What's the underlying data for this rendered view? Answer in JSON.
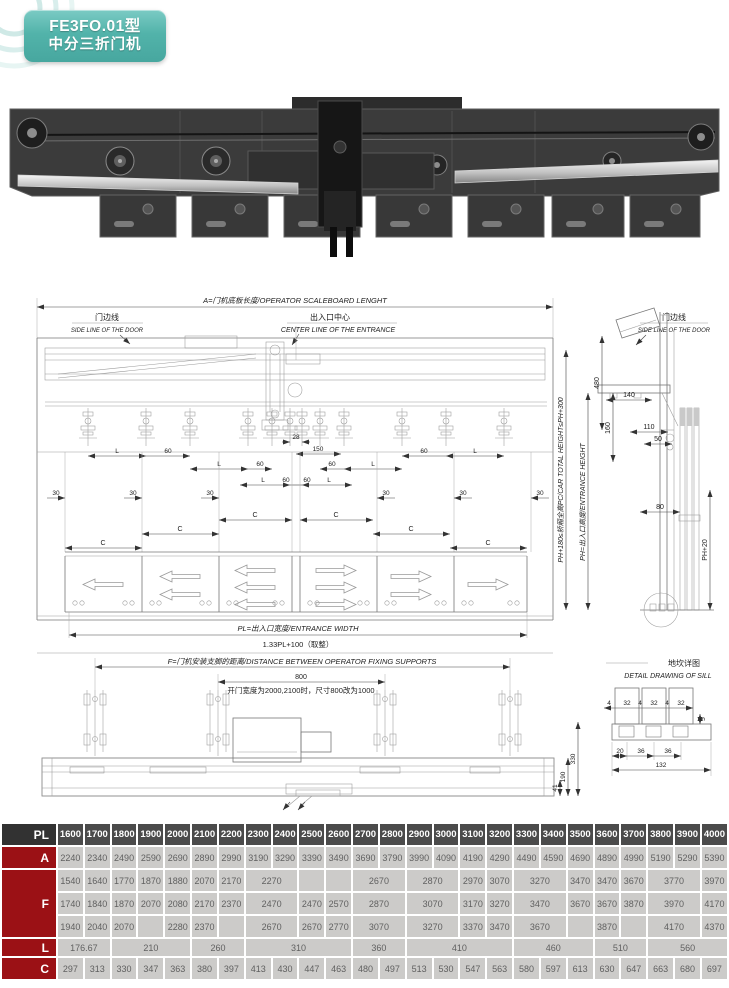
{
  "badge": {
    "model": "FE3FO.01型",
    "name": "中分三折门机"
  },
  "drawing_main": {
    "title": "A=门机底板长度/OPERATOR  SCALEBOARD  LENGHT",
    "side_line_cn": "门边线",
    "side_line_en": "SIDE LINE OF THE DOOR",
    "center_cn": "出入口中心",
    "center_en": "CENTER LINE OF THE ENTRANCE",
    "dim_L": "L",
    "dim_60": "60",
    "dim_30": "30",
    "dim_C": "C",
    "dim_28": "28",
    "dim_150": "150",
    "pl_label": "PL=出入口宽度/ENTRANCE WIDTH",
    "pl_formula": "1.33PL+100（取整）"
  },
  "drawing_section": {
    "d480": "480",
    "d140": "140",
    "d160": "160",
    "d110": "110",
    "d50": "50",
    "d80": "80",
    "ph20": "PH+20",
    "car_total_height": "PH+180≤轿厢全高PC/CAR  TOTAL  HEIGHT≤PH+300",
    "entrance_height": "PH=出入口高度/ENTRANCE  HEIGHT"
  },
  "drawing_fixing": {
    "title": "F=门机安装支脚的距离/DISTANCE  BETWEEN  OPERATOR  FIXING  SUPPORTS",
    "d800": "800",
    "note": "开门宽度为2000,2100时，尺寸800改为1000",
    "d41": "41",
    "d190": "190",
    "d330": "330"
  },
  "drawing_sill": {
    "title_cn": "地坎详图",
    "title_en": "DETAIL  DRAWING  OF  SILL",
    "d4": "4",
    "d32": "32",
    "d5": "5",
    "d20": "20",
    "d36": "36",
    "d132": "132"
  },
  "table": {
    "row_labels": {
      "pl": "PL",
      "a": "A",
      "f": "F",
      "l": "L",
      "c": "C"
    },
    "columns": [
      "1600",
      "1700",
      "1800",
      "1900",
      "2000",
      "2100",
      "2200",
      "2300",
      "2400",
      "2500",
      "2600",
      "2700",
      "2800",
      "2900",
      "3000",
      "3100",
      "3200",
      "3300",
      "3400",
      "3500",
      "3600",
      "3700",
      "3800",
      "3900",
      "4000"
    ],
    "row_a": [
      "2240",
      "2340",
      "2490",
      "2590",
      "2690",
      "2890",
      "2990",
      "3190",
      "3290",
      "3390",
      "3490",
      "3690",
      "3790",
      "3990",
      "4090",
      "4190",
      "4290",
      "4490",
      "4590",
      "4690",
      "4890",
      "4990",
      "5190",
      "5290",
      "5390"
    ],
    "row_f": [
      [
        [
          "1540",
          1
        ],
        [
          "1640",
          1
        ],
        [
          "1770",
          1
        ],
        [
          "1870",
          1
        ],
        [
          "1880",
          1
        ],
        [
          "2070",
          1
        ],
        [
          "2170",
          1
        ],
        [
          "2270",
          2
        ],
        [
          "",
          1
        ],
        [
          "",
          1
        ],
        [
          "2670",
          2
        ],
        [
          "2870",
          2
        ],
        [
          "2970",
          1
        ],
        [
          "3070",
          1
        ],
        [
          "3270",
          2
        ],
        [
          "3470",
          1
        ],
        [
          "3470",
          1
        ],
        [
          "3670",
          1
        ],
        [
          "3770",
          2
        ],
        [
          "3970",
          1
        ]
      ],
      [
        [
          "1740",
          1
        ],
        [
          "1840",
          1
        ],
        [
          "1870",
          1
        ],
        [
          "2070",
          1
        ],
        [
          "2080",
          1
        ],
        [
          "2170",
          1
        ],
        [
          "2370",
          1
        ],
        [
          "2470",
          2
        ],
        [
          "2470",
          1
        ],
        [
          "2570",
          1
        ],
        [
          "2870",
          2
        ],
        [
          "3070",
          2
        ],
        [
          "3170",
          1
        ],
        [
          "3270",
          1
        ],
        [
          "3470",
          2
        ],
        [
          "3670",
          1
        ],
        [
          "3670",
          1
        ],
        [
          "3870",
          1
        ],
        [
          "3970",
          2
        ],
        [
          "4170",
          1
        ]
      ],
      [
        [
          "1940",
          1
        ],
        [
          "2040",
          1
        ],
        [
          "2070",
          1
        ],
        [
          "",
          1
        ],
        [
          "2280",
          1
        ],
        [
          "2370",
          1
        ],
        [
          "",
          1
        ],
        [
          "2670",
          2
        ],
        [
          "2670",
          1
        ],
        [
          "2770",
          1
        ],
        [
          "3070",
          2
        ],
        [
          "3270",
          2
        ],
        [
          "3370",
          1
        ],
        [
          "3470",
          1
        ],
        [
          "3670",
          2
        ],
        [
          "",
          1
        ],
        [
          "3870",
          1
        ],
        [
          "",
          1
        ],
        [
          "4170",
          2
        ],
        [
          "4370",
          1
        ]
      ]
    ],
    "row_l": [
      [
        "176.67",
        2
      ],
      [
        "210",
        3
      ],
      [
        "260",
        2
      ],
      [
        "310",
        4
      ],
      [
        "360",
        2
      ],
      [
        "410",
        4
      ],
      [
        "460",
        3
      ],
      [
        "510",
        2
      ],
      [
        "560",
        3
      ]
    ],
    "row_c": [
      "297",
      "313",
      "330",
      "347",
      "363",
      "380",
      "397",
      "413",
      "430",
      "447",
      "463",
      "480",
      "497",
      "513",
      "530",
      "547",
      "563",
      "580",
      "597",
      "613",
      "630",
      "647",
      "663",
      "680",
      "697"
    ]
  }
}
